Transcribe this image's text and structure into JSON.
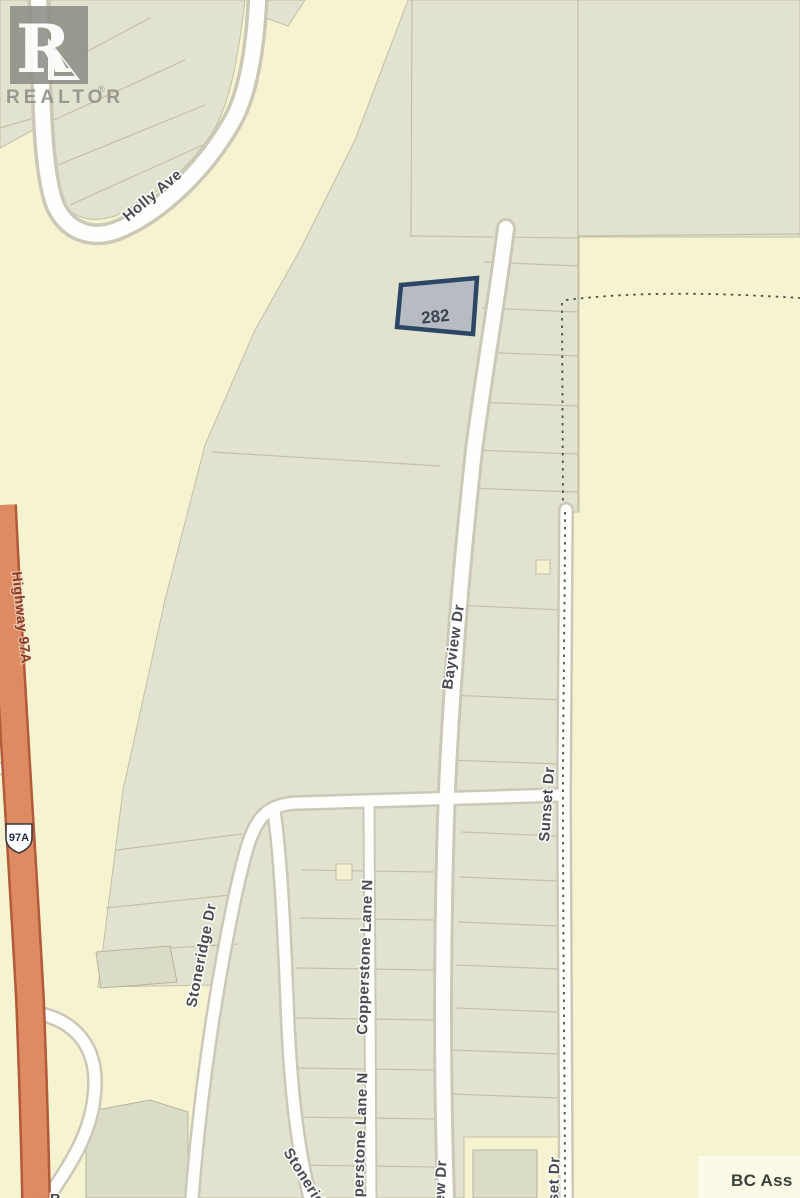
{
  "branding": {
    "logo_initial": "R",
    "logo_word": "REALTOR",
    "registered_mark": "®"
  },
  "attribution": {
    "text": "BC Ass"
  },
  "highlighted_parcel": {
    "number": "282"
  },
  "highway_shield": {
    "text": "97A"
  },
  "labels": {
    "holly_ave": "Holly Ave",
    "highway_97a": "Highway 97A",
    "stoneridge_dr": "Stoneridge Dr",
    "stoneridge_dr_south": "Stoneridge Dr",
    "copperstone_lane": "Copperstone Lane N",
    "copperstone_lane_south": "Copperstone Lane N",
    "bayview_dr": "Bayview Dr",
    "bayview_dr_south": "Bayview Dr",
    "sunset_dr": "Sunset Dr",
    "sunset_dr_south": "Sunset Dr",
    "partial_street_b": "B"
  },
  "colors": {
    "background": "#f6f3d1",
    "parcel_area": "#e1e2cf",
    "road": "#fefefc",
    "highway": "#de8a62",
    "highlight_border": "#2c4766",
    "highlight_fill": "#b7bcc3",
    "street_text": "#4a4a52",
    "highway_text": "#8a3a24"
  }
}
